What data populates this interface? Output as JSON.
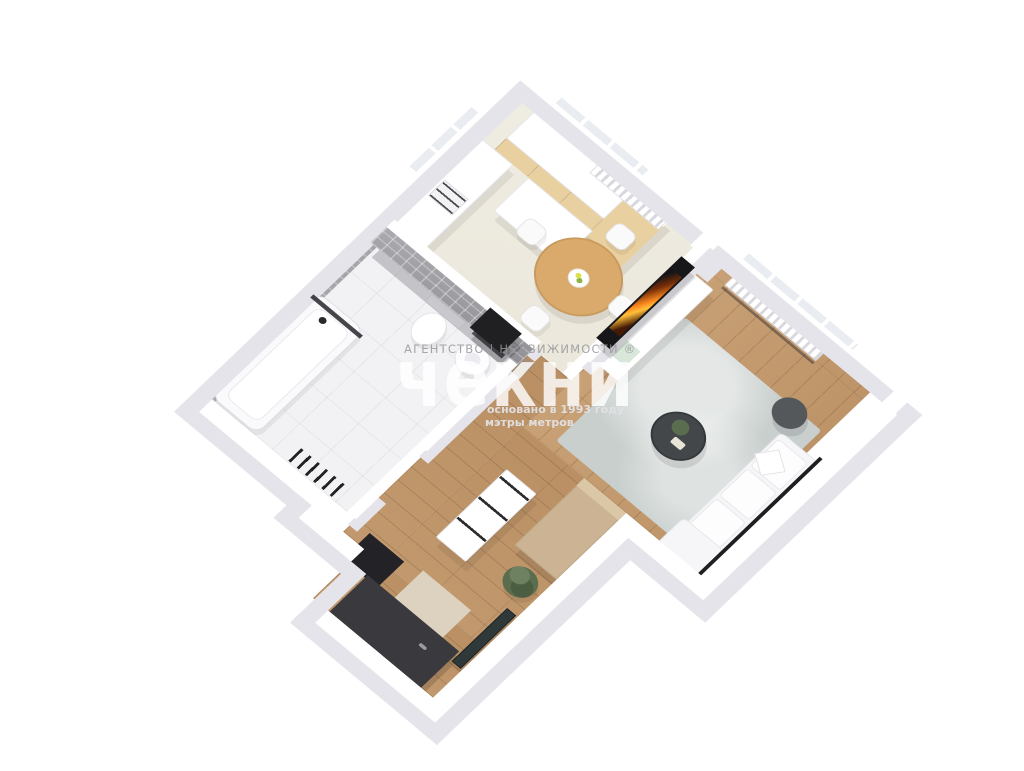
{
  "watermark": {
    "agency_line": "АГЕНТСТВО | НЕДВИЖИМОСТИ ®",
    "brand": "чекни",
    "founded": "основано в 1993 году",
    "tagline": "мэтры метров"
  },
  "palette": {
    "bg": "#ffffff",
    "wall": "#ffffff",
    "wall_side": "#e4e4ea",
    "floor_kitchen": "#efece2",
    "floor_bath": "#f2f2f4",
    "wood_floor": "#c9a176",
    "wood_floor_hall": "#c2996e",
    "wood_cabinet": "#e9d0a0",
    "wood_cabinet_gray": "#cbb393",
    "table_wood": "#d9aa6c",
    "rug": "#c8cfcd",
    "tile": "#9c9ca0",
    "dark": "#232327",
    "door_dark": "#39393e",
    "tv_black": "#17171a",
    "tv_flame": "#ff8c1f",
    "plant": "#5a6d4f",
    "sofa": "#f6f6f8"
  }
}
